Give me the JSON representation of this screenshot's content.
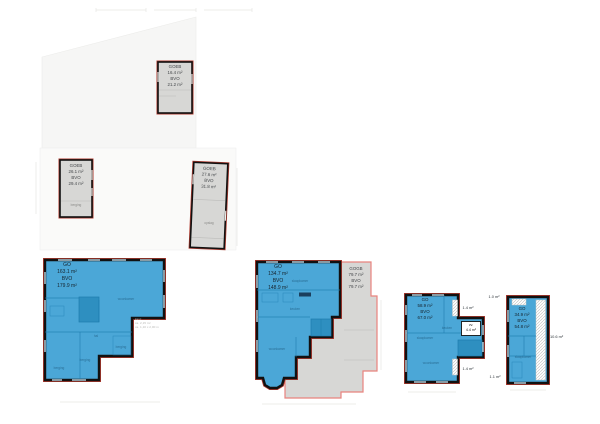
{
  "drawing": {
    "colors": {
      "unit_fill": "#4BA7D7",
      "unit_fill_dark": "#2E8FC0",
      "unit_line": "#1E7CAE",
      "counter_fill": "#1B3F5E",
      "storage_fill": "#D7D7D5",
      "wall_black": "#111111",
      "outline_red": "#B03A2E",
      "outline_pink": "#E8837E",
      "site_fill": "#F6F6F5",
      "text_dark": "#333333",
      "text_faint": "#B9B9B6"
    },
    "plans": {
      "attic": {
        "type_label": "GOEB",
        "area": "16.4 m²",
        "gross_label": "BVO",
        "gross_area": "21.2 m²"
      },
      "storage_left": {
        "type_label": "GOEB",
        "area": "26.1 m²",
        "gross_label": "BVO",
        "gross_area": "29.4 m²",
        "room": "berging"
      },
      "storage_right": {
        "type_label": "GOEB",
        "area": "27.6 m²",
        "gross_label": "BVO",
        "gross_area": "31.8 m²",
        "room": "opslag"
      },
      "ground_floor": {
        "type_label": "GO",
        "area": "163.1 m²",
        "gross_label": "BVO",
        "gross_area": "179.9 m²",
        "rooms": [
          "woonkamer",
          "hal",
          "berging",
          "berging",
          "berging"
        ],
        "annotation": [
          "kast:",
          "ca. 2,15 m²",
          "ca. 1,10 x 2,00 m"
        ]
      },
      "first_floor": {
        "type_label": "GO",
        "area": "134.7 m²",
        "gross_label": "BVO",
        "gross_area": "148.9 m²",
        "rooms": [
          "slaapkamer",
          "keuken",
          "woonkamer"
        ],
        "adjoining": {
          "type_label": "GOGB",
          "area": "79.7 m²",
          "gross_label": "BVO",
          "gross_area": "79.7 m²"
        }
      },
      "second_floor": {
        "type_label": "GO",
        "area": "58.9 m²",
        "gross_label": "BVO",
        "gross_area": "67.0 m²",
        "rooms": [
          "slaapkamer",
          "woonkamer",
          "keuken"
        ],
        "exterior_top": "1.4 m²",
        "exterior_bottom": "1.4 m²",
        "void": {
          "label": "vv.",
          "area": "4.4 m²"
        }
      },
      "top_floor": {
        "type_label": "GO",
        "area": "34.9 m²",
        "gross_label": "BVO",
        "gross_area": "54.8 m²",
        "rooms": [
          "slaapkamer"
        ],
        "exterior_top": "1.0 m²",
        "exterior_bottom": "1.1 m²",
        "exterior_right": "10.6 m²"
      }
    }
  }
}
